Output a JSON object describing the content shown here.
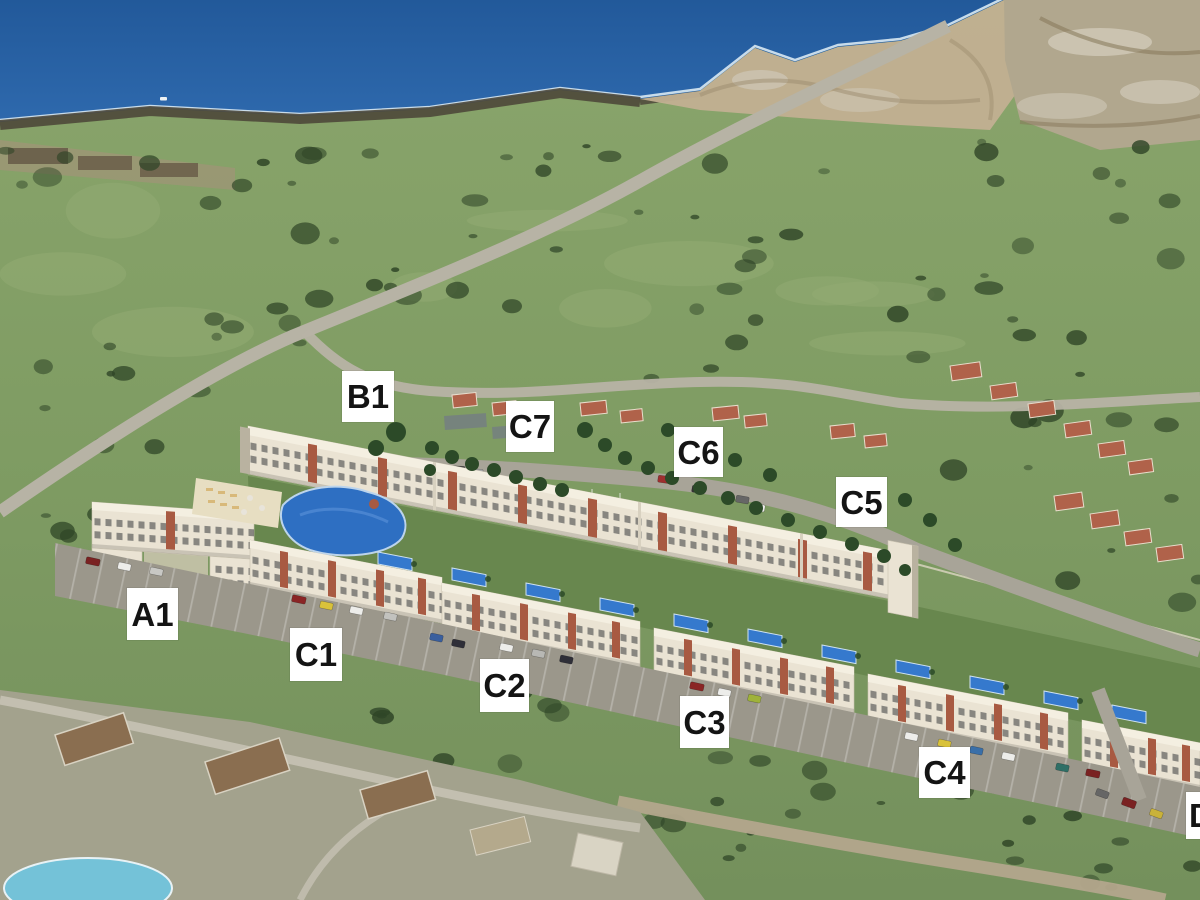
{
  "meta": {
    "title": "Coastal resort development site plan — aerial 3D visualization"
  },
  "scene": {
    "description": "3D architectural render of an apartment resort complex superimposed on an aerial photo of a coastline, with white phase labels",
    "colors": {
      "sea_deep": "#275f9f",
      "sea_light": "#4280bf",
      "surf": "#d9e9f2",
      "shore_rock": "#4e483a",
      "sand": "#c2b092",
      "quarry": "#b1a78e",
      "land": "#7f9c63",
      "land_light": "#93ac74",
      "scrub": "#2f4527",
      "road": "#b7b3a5",
      "road_tan": "#b3a68c",
      "building": "#eae3d3",
      "building_roof": "#f4efe1",
      "building_shade": "#b9b2a0",
      "accent_terracotta": "#a85a42",
      "villa_roof": "#b0624a",
      "lagoon": "#2e6fc2",
      "pool": "#3579cd",
      "deck": "#e7dec2",
      "green_strip": "#68874e",
      "tree": "#2c4a28",
      "parking": "#9b978b",
      "photo_area": "#a3a28d",
      "photo_roof": "#8a6e50",
      "photo_pool": "#74c2d8",
      "label_bg": "#ffffff",
      "label_text": "#141414"
    },
    "labels": [
      {
        "id": "b1",
        "text": "B1",
        "x": 342,
        "y": 371,
        "w": 52,
        "h": 51
      },
      {
        "id": "c7",
        "text": "C7",
        "x": 506,
        "y": 401,
        "w": 48,
        "h": 51
      },
      {
        "id": "c6",
        "text": "C6",
        "x": 674,
        "y": 427,
        "w": 49,
        "h": 50
      },
      {
        "id": "c5",
        "text": "C5",
        "x": 836,
        "y": 477,
        "w": 51,
        "h": 50
      },
      {
        "id": "a1",
        "text": "A1",
        "x": 127,
        "y": 588,
        "w": 51,
        "h": 52
      },
      {
        "id": "c1",
        "text": "C1",
        "x": 290,
        "y": 628,
        "w": 52,
        "h": 53
      },
      {
        "id": "c2",
        "text": "C2",
        "x": 480,
        "y": 659,
        "w": 49,
        "h": 53
      },
      {
        "id": "c3",
        "text": "C3",
        "x": 680,
        "y": 696,
        "w": 49,
        "h": 52
      },
      {
        "id": "c4",
        "text": "C4",
        "x": 919,
        "y": 747,
        "w": 51,
        "h": 51
      },
      {
        "id": "d",
        "text": "D",
        "x": 1186,
        "y": 792,
        "w": 47,
        "h": 47,
        "align": "left"
      }
    ]
  }
}
